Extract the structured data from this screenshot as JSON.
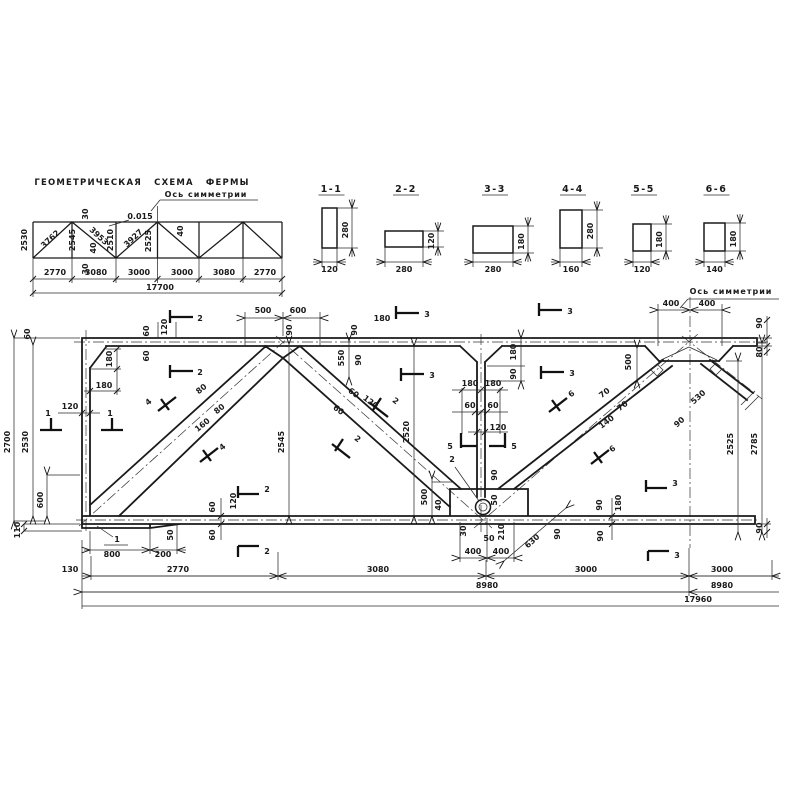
{
  "drawing": {
    "schematic": {
      "title": {
        "t": "ГЕОМЕТРИЧЕСКАЯ СХЕМА ФЕРМЫ",
        "x": 142,
        "y": 185,
        "c": "ttl",
        "n": "schematic-title"
      },
      "labels": [
        {
          "t": "Ось симметрии",
          "x": 206,
          "y": 197,
          "c": "ax",
          "n": "axis-of-symmetry-label"
        },
        {
          "t": "0.015",
          "x": 140,
          "y": 219
        },
        {
          "t": "2530",
          "x": 27,
          "y": 240,
          "r": -90
        },
        {
          "t": "3762",
          "x": 52,
          "y": 241,
          "r": -43
        },
        {
          "t": "2545",
          "x": 75,
          "y": 240,
          "r": -90
        },
        {
          "t": "30",
          "x": 88,
          "y": 214,
          "r": -90
        },
        {
          "t": "3953",
          "x": 97,
          "y": 238,
          "r": 43
        },
        {
          "t": "40",
          "x": 96,
          "y": 248,
          "r": -90
        },
        {
          "t": "30",
          "x": 88,
          "y": 269,
          "r": -90
        },
        {
          "t": "2510",
          "x": 113,
          "y": 240,
          "r": -90
        },
        {
          "t": "3927",
          "x": 135,
          "y": 240,
          "r": -43
        },
        {
          "t": "2525",
          "x": 151,
          "y": 241,
          "r": -90
        },
        {
          "t": "40",
          "x": 183,
          "y": 231,
          "r": -90
        },
        {
          "t": "2770",
          "x": 55,
          "y": 275
        },
        {
          "t": "3080",
          "x": 96,
          "y": 275
        },
        {
          "t": "3000",
          "x": 139,
          "y": 275
        },
        {
          "t": "3000",
          "x": 182,
          "y": 275
        },
        {
          "t": "3080",
          "x": 224,
          "y": 275
        },
        {
          "t": "2770",
          "x": 265,
          "y": 275
        },
        {
          "t": "17700",
          "x": 160,
          "y": 290
        }
      ]
    },
    "sections": [
      {
        "name": "1-1",
        "width": "120",
        "height": "280",
        "rx": 322,
        "ry": 208,
        "rw": 15,
        "rh": 40
      },
      {
        "name": "2-2",
        "width": "280",
        "height": "120",
        "rx": 385,
        "ry": 231,
        "rw": 38,
        "rh": 16
      },
      {
        "name": "3-3",
        "width": "280",
        "height": "180",
        "rx": 473,
        "ry": 226,
        "rw": 40,
        "rh": 27
      },
      {
        "name": "4-4",
        "width": "160",
        "height": "280",
        "rx": 560,
        "ry": 210,
        "rw": 22,
        "rh": 38
      },
      {
        "name": "5-5",
        "width": "120",
        "height": "180",
        "rx": 633,
        "ry": 224,
        "rw": 18,
        "rh": 27
      },
      {
        "name": "6-6",
        "width": "140",
        "height": "180",
        "rx": 704,
        "ry": 223,
        "rw": 21,
        "rh": 28
      }
    ],
    "elevation": {
      "labels": [
        {
          "t": "60",
          "x": 30,
          "y": 334,
          "r": -90
        },
        {
          "t": "2700",
          "x": 10,
          "y": 442,
          "r": -90
        },
        {
          "t": "2530",
          "x": 28,
          "y": 442,
          "r": -90
        },
        {
          "t": "600",
          "x": 43,
          "y": 500,
          "r": -90
        },
        {
          "t": "110",
          "x": 20,
          "y": 530,
          "r": -90
        },
        {
          "t": "120",
          "x": 70,
          "y": 409
        },
        {
          "t": "180",
          "x": 112,
          "y": 359,
          "r": -90
        },
        {
          "t": "180",
          "x": 104,
          "y": 388
        },
        {
          "t": "60",
          "x": 149,
          "y": 331,
          "r": -90
        },
        {
          "t": "120",
          "x": 167,
          "y": 327,
          "r": -90
        },
        {
          "t": "60",
          "x": 149,
          "y": 356,
          "r": -90
        },
        {
          "t": "500",
          "x": 263,
          "y": 313
        },
        {
          "t": "600",
          "x": 298,
          "y": 313
        },
        {
          "t": "90",
          "x": 292,
          "y": 330,
          "r": -90
        },
        {
          "t": "90",
          "x": 357,
          "y": 330,
          "r": -90
        },
        {
          "t": "180",
          "x": 382,
          "y": 321
        },
        {
          "t": "550",
          "x": 344,
          "y": 358,
          "r": -90
        },
        {
          "t": "90",
          "x": 361,
          "y": 360,
          "r": -90
        },
        {
          "t": "180",
          "x": 470,
          "y": 386
        },
        {
          "t": "180",
          "x": 493,
          "y": 386
        },
        {
          "t": "60",
          "x": 470,
          "y": 408
        },
        {
          "t": "60",
          "x": 493,
          "y": 408
        },
        {
          "t": "120",
          "x": 498,
          "y": 430
        },
        {
          "t": "180",
          "x": 516,
          "y": 352,
          "r": -90
        },
        {
          "t": "90",
          "x": 516,
          "y": 374,
          "r": -90
        },
        {
          "t": "2545",
          "x": 284,
          "y": 442,
          "r": -90
        },
        {
          "t": "2520",
          "x": 409,
          "y": 432,
          "r": -90
        },
        {
          "t": "80",
          "x": 203,
          "y": 391,
          "r": -39
        },
        {
          "t": "80",
          "x": 221,
          "y": 411,
          "r": -39
        },
        {
          "t": "160",
          "x": 204,
          "y": 427,
          "r": -39
        },
        {
          "t": "60",
          "x": 352,
          "y": 395,
          "r": 37
        },
        {
          "t": "60",
          "x": 337,
          "y": 412,
          "r": 37
        },
        {
          "t": "120",
          "x": 369,
          "y": 404,
          "r": 37
        },
        {
          "t": "70",
          "x": 606,
          "y": 395,
          "r": -37
        },
        {
          "t": "70",
          "x": 624,
          "y": 408,
          "r": -37
        },
        {
          "t": "140",
          "x": 608,
          "y": 424,
          "r": -37
        },
        {
          "t": "400",
          "x": 671,
          "y": 306
        },
        {
          "t": "400",
          "x": 707,
          "y": 306
        },
        {
          "t": "500",
          "x": 631,
          "y": 362,
          "r": -90
        },
        {
          "t": "530",
          "x": 700,
          "y": 399,
          "r": -42
        },
        {
          "t": "90",
          "x": 681,
          "y": 424,
          "r": -42
        },
        {
          "t": "90",
          "x": 762,
          "y": 323,
          "r": -90
        },
        {
          "t": "80",
          "x": 762,
          "y": 352,
          "r": -90
        },
        {
          "t": "2525",
          "x": 733,
          "y": 444,
          "r": -90
        },
        {
          "t": "2785",
          "x": 757,
          "y": 444,
          "r": -90
        },
        {
          "t": "90",
          "x": 762,
          "y": 528,
          "r": -90
        },
        {
          "t": "500",
          "x": 427,
          "y": 497,
          "r": -90
        },
        {
          "t": "40",
          "x": 441,
          "y": 505,
          "r": -90
        },
        {
          "t": "90",
          "x": 497,
          "y": 475,
          "r": -90
        },
        {
          "t": "50",
          "x": 497,
          "y": 500,
          "r": -90
        },
        {
          "t": "30",
          "x": 466,
          "y": 531,
          "r": -90
        },
        {
          "t": "50",
          "x": 489,
          "y": 541
        },
        {
          "t": "210",
          "x": 504,
          "y": 532,
          "r": -90
        },
        {
          "t": "400",
          "x": 473,
          "y": 554
        },
        {
          "t": "400",
          "x": 501,
          "y": 554
        },
        {
          "t": "630",
          "x": 534,
          "y": 543,
          "r": -42
        },
        {
          "t": "90",
          "x": 560,
          "y": 534,
          "r": -90
        },
        {
          "t": "60",
          "x": 215,
          "y": 507,
          "r": -90
        },
        {
          "t": "120",
          "x": 236,
          "y": 501,
          "r": -90
        },
        {
          "t": "60",
          "x": 215,
          "y": 535,
          "r": -90
        },
        {
          "t": "50",
          "x": 173,
          "y": 535,
          "r": -90
        },
        {
          "t": "800",
          "x": 112,
          "y": 557
        },
        {
          "t": "200",
          "x": 163,
          "y": 557
        },
        {
          "t": "90",
          "x": 602,
          "y": 505,
          "r": -90
        },
        {
          "t": "180",
          "x": 621,
          "y": 503,
          "r": -90
        },
        {
          "t": "90",
          "x": 603,
          "y": 536,
          "r": -90
        },
        {
          "t": "130",
          "x": 70,
          "y": 572
        },
        {
          "t": "2770",
          "x": 178,
          "y": 572
        },
        {
          "t": "3080",
          "x": 378,
          "y": 572
        },
        {
          "t": "3000",
          "x": 586,
          "y": 572
        },
        {
          "t": "3000",
          "x": 722,
          "y": 572
        },
        {
          "t": "8980",
          "x": 487,
          "y": 588
        },
        {
          "t": "8980",
          "x": 722,
          "y": 588
        },
        {
          "t": "17960",
          "x": 698,
          "y": 602
        },
        {
          "t": "1",
          "x": 117,
          "y": 542,
          "n": "detail-mark-1"
        },
        {
          "t": "2",
          "x": 452,
          "y": 462,
          "n": "detail-mark-2"
        },
        {
          "t": "1",
          "x": 48,
          "y": 416,
          "n": "cut-label-1"
        },
        {
          "t": "1",
          "x": 110,
          "y": 416,
          "n": "cut-label-1"
        },
        {
          "t": "2",
          "x": 200,
          "y": 321,
          "n": "cut-label-2"
        },
        {
          "t": "2",
          "x": 200,
          "y": 375,
          "n": "cut-label-2"
        },
        {
          "t": "3",
          "x": 427,
          "y": 317,
          "n": "cut-label-3"
        },
        {
          "t": "3",
          "x": 432,
          "y": 378,
          "n": "cut-label-3"
        },
        {
          "t": "3",
          "x": 570,
          "y": 314,
          "n": "cut-label-3"
        },
        {
          "t": "3",
          "x": 572,
          "y": 376,
          "n": "cut-label-3"
        },
        {
          "t": "5",
          "x": 450,
          "y": 449,
          "n": "cut-label-5"
        },
        {
          "t": "5",
          "x": 514,
          "y": 449,
          "n": "cut-label-5"
        },
        {
          "t": "2",
          "x": 267,
          "y": 492,
          "n": "cut-label-2"
        },
        {
          "t": "2",
          "x": 267,
          "y": 554,
          "n": "cut-label-2"
        },
        {
          "t": "3",
          "x": 675,
          "y": 486,
          "n": "cut-label-3"
        },
        {
          "t": "3",
          "x": 677,
          "y": 558,
          "n": "cut-label-3"
        },
        {
          "t": "4",
          "x": 150,
          "y": 404,
          "r": -39,
          "n": "cut-label-4"
        },
        {
          "t": "4",
          "x": 224,
          "y": 449,
          "r": -39,
          "n": "cut-label-4"
        },
        {
          "t": "2",
          "x": 394,
          "y": 403,
          "r": 37,
          "n": "cut-label-2"
        },
        {
          "t": "2",
          "x": 356,
          "y": 441,
          "r": 37,
          "n": "cut-label-2"
        },
        {
          "t": "6",
          "x": 573,
          "y": 396,
          "r": -37,
          "n": "cut-label-6"
        },
        {
          "t": "6",
          "x": 614,
          "y": 451,
          "r": -37,
          "n": "cut-label-6"
        },
        {
          "t": "Ось симметрии",
          "x": 731,
          "y": 294,
          "c": "ax",
          "n": "axis-of-symmetry-label"
        }
      ],
      "dim_lines": [
        [
          14,
          338,
          14,
          521
        ],
        [
          33,
          345,
          33,
          516
        ],
        [
          47,
          475,
          47,
          516
        ],
        [
          289,
          344,
          289,
          516
        ],
        [
          414,
          346,
          414,
          516
        ],
        [
          738,
          361,
          738,
          532
        ],
        [
          762,
          343,
          762,
          532
        ],
        [
          432,
          479,
          432,
          516
        ],
        [
          637,
          348,
          637,
          380
        ],
        [
          349,
          341,
          349,
          377
        ],
        [
          521,
          338,
          521,
          381
        ],
        [
          91,
          576,
          278,
          576
        ],
        [
          278,
          576,
          486,
          576
        ],
        [
          486,
          576,
          689,
          576
        ],
        [
          689,
          576,
          772,
          576
        ],
        [
          82,
          592,
          689,
          592
        ],
        [
          90,
          550,
          150,
          550
        ],
        [
          150,
          550,
          177,
          550
        ],
        [
          658,
          310,
          690,
          310
        ],
        [
          690,
          310,
          722,
          310
        ],
        [
          245,
          318,
          283,
          318
        ],
        [
          283,
          318,
          320,
          318
        ],
        [
          460,
          558,
          487,
          558
        ],
        [
          487,
          558,
          514,
          558
        ],
        [
          504,
          561,
          566,
          508
        ]
      ]
    }
  }
}
